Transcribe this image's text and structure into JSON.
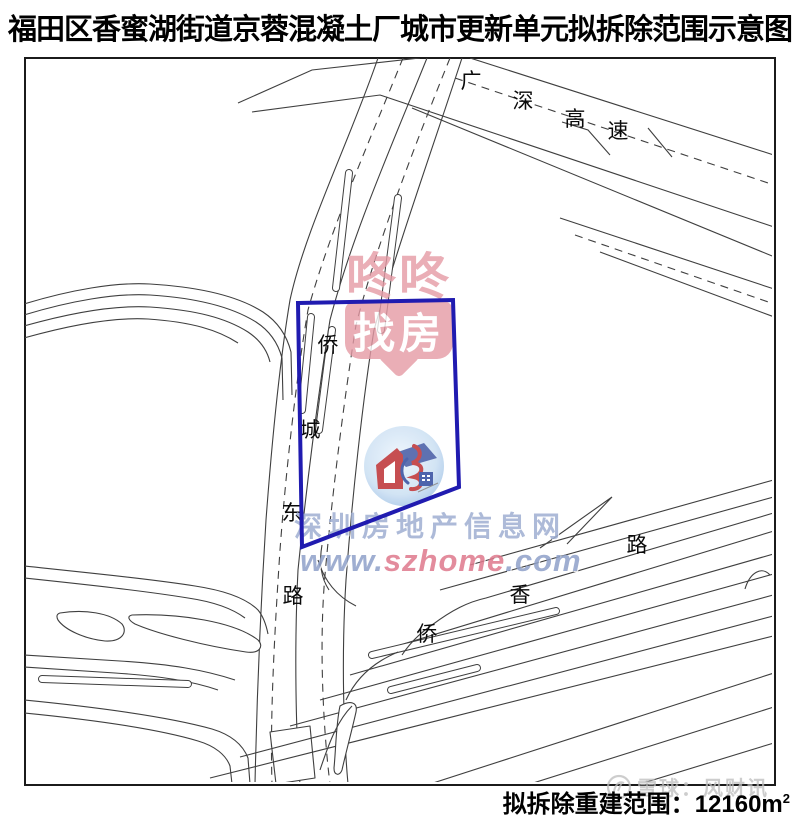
{
  "title": "福田区香蜜湖街道京蓉混凝土厂城市更新单元拟拆除范围示意图",
  "map": {
    "boundary_color": "#201bb0",
    "roads": {
      "gs": [
        "广",
        "深",
        "高",
        "速"
      ],
      "qcd": [
        "侨",
        "城",
        "东",
        "路"
      ],
      "qx": [
        "侨",
        "香",
        "路"
      ]
    }
  },
  "watermarks": {
    "dongdong": {
      "row1": "咚咚",
      "row2": "找房",
      "color": "#e59aa5"
    },
    "szhome": {
      "line1": "深圳房地产信息网",
      "www": "www.",
      "brand": "szhome",
      "tld": ".com"
    },
    "xueqiu": {
      "text": "雪球：风财讯"
    }
  },
  "footer": {
    "label": "拟拆除重建范围：",
    "value": "12160m",
    "sup": "2"
  }
}
